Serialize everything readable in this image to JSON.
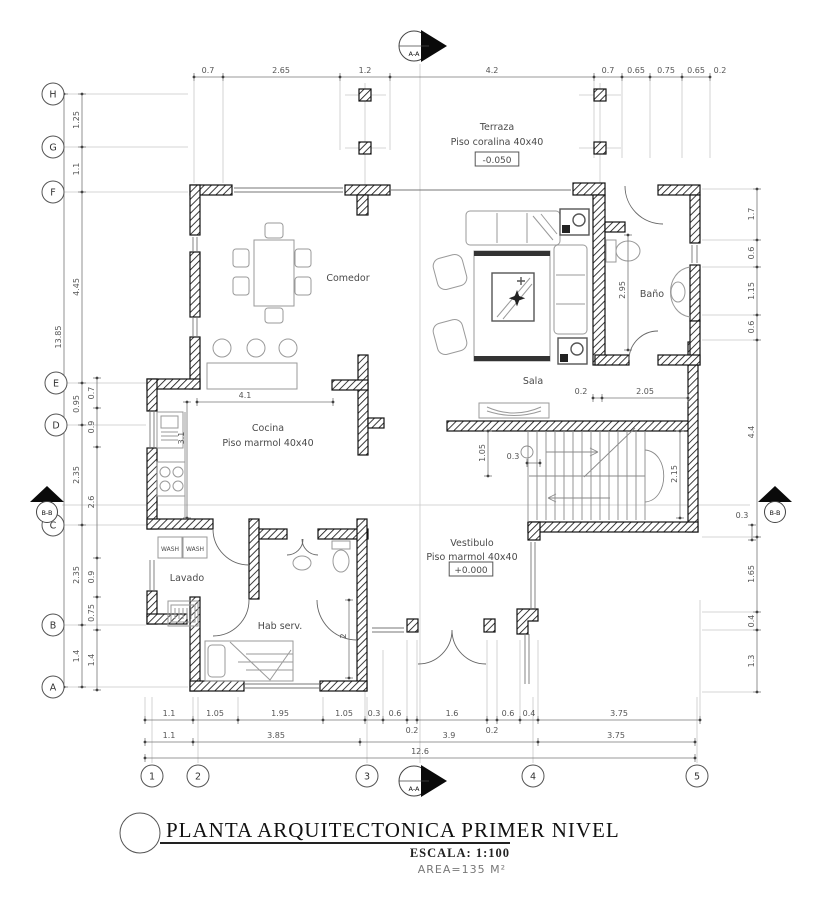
{
  "title_block": {
    "title": "PLANTA ARQUITECTONICA PRIMER NIVEL",
    "scale": "ESCALA: 1:100",
    "area": "AREA=135 M²"
  },
  "grid": {
    "bubbles": [
      {
        "t": "H",
        "x": 53,
        "y": 94
      },
      {
        "t": "G",
        "x": 53,
        "y": 147
      },
      {
        "t": "F",
        "x": 53,
        "y": 192
      },
      {
        "t": "E",
        "x": 56,
        "y": 383
      },
      {
        "t": "D",
        "x": 56,
        "y": 425
      },
      {
        "t": "C",
        "x": 53,
        "y": 525
      },
      {
        "t": "B",
        "x": 53,
        "y": 625
      },
      {
        "t": "A",
        "x": 53,
        "y": 687
      },
      {
        "t": "1",
        "x": 152,
        "y": 776
      },
      {
        "t": "2",
        "x": 198,
        "y": 776
      },
      {
        "t": "3",
        "x": 367,
        "y": 776
      },
      {
        "t": "4",
        "x": 533,
        "y": 776
      },
      {
        "t": "5",
        "x": 697,
        "y": 776
      }
    ]
  },
  "section_markers": [
    {
      "t": "A-A",
      "x": 414,
      "y": 46,
      "type": "right"
    },
    {
      "t": "A-A",
      "x": 414,
      "y": 781,
      "type": "right"
    },
    {
      "t": "B-B",
      "x": 47,
      "y": 509,
      "type": "up"
    },
    {
      "t": "B-B",
      "x": 775,
      "y": 509,
      "type": "up"
    }
  ],
  "rooms": {
    "labels": [
      {
        "t": [
          "Terraza",
          "Piso coralina 40x40"
        ],
        "x": 497,
        "y": 130,
        "lh": 15
      },
      {
        "t": [
          "Comedor"
        ],
        "x": 348,
        "y": 281
      },
      {
        "t": [
          "Sala"
        ],
        "x": 533,
        "y": 384
      },
      {
        "t": [
          "Baño"
        ],
        "x": 652,
        "y": 297
      },
      {
        "t": [
          "Cocina",
          "Piso marmol 40x40"
        ],
        "x": 268,
        "y": 431,
        "lh": 15
      },
      {
        "t": [
          "Vestibulo",
          "Piso marmol 40x40"
        ],
        "x": 472,
        "y": 546,
        "lh": 14
      },
      {
        "t": [
          "Lavado"
        ],
        "x": 187,
        "y": 581
      },
      {
        "t": [
          "Hab serv."
        ],
        "x": 280,
        "y": 629
      },
      {
        "t": [
          "WASH"
        ],
        "x": 170,
        "y": 551,
        "s": 6
      },
      {
        "t": [
          "WASH"
        ],
        "x": 195,
        "y": 551,
        "s": 6
      }
    ],
    "levels": [
      {
        "t": "-0.050",
        "x": 497,
        "y": 160
      },
      {
        "t": "+0.000",
        "x": 471,
        "y": 570
      }
    ]
  },
  "dimensions": [
    {
      "o": "h",
      "pos": 77,
      "from": 194,
      "to": 710,
      "ticks": [
        194,
        223,
        340,
        390,
        594,
        622,
        650,
        682,
        710
      ],
      "labels": [
        {
          "t": "0.7",
          "at": 208
        },
        {
          "t": "2.65",
          "at": 281
        },
        {
          "t": "1.2",
          "at": 365
        },
        {
          "t": "4.2",
          "at": 492
        },
        {
          "t": "0.7",
          "at": 608
        },
        {
          "t": "0.65",
          "at": 636
        },
        {
          "t": "0.75",
          "at": 666
        },
        {
          "t": "0.65",
          "at": 696
        },
        {
          "t": "0.2",
          "at": 720
        }
      ]
    },
    {
      "o": "v",
      "pos": 64,
      "from": 94,
      "to": 687,
      "ticks": [
        94,
        687
      ],
      "labels": [
        {
          "t": "13.85",
          "at": 337
        }
      ]
    },
    {
      "o": "v",
      "pos": 82,
      "from": 94,
      "to": 687,
      "ticks": [
        94,
        147,
        192,
        383,
        425,
        525,
        625,
        687
      ],
      "labels": [
        {
          "t": "1.25",
          "at": 120
        },
        {
          "t": "1.1",
          "at": 169
        },
        {
          "t": "4.45",
          "at": 287
        },
        {
          "t": "0.95",
          "at": 404
        },
        {
          "t": "2.35",
          "at": 475
        },
        {
          "t": "2.35",
          "at": 575
        },
        {
          "t": "1.4",
          "at": 656
        }
      ]
    },
    {
      "o": "v",
      "pos": 97,
      "from": 378,
      "to": 690,
      "ticks": [
        378,
        408,
        447,
        558,
        597,
        630,
        690
      ],
      "labels": [
        {
          "t": "0.7",
          "at": 393
        },
        {
          "t": "0.9",
          "at": 427
        },
        {
          "t": "2.6",
          "at": 502
        },
        {
          "t": "0.9",
          "at": 577
        },
        {
          "t": "0.75",
          "at": 613
        },
        {
          "t": "1.4",
          "at": 660
        }
      ]
    },
    {
      "o": "v",
      "pos": 757,
      "from": 189,
      "to": 692,
      "ticks": [
        189,
        240,
        267,
        315,
        340,
        537,
        612,
        630,
        692
      ],
      "labels": [
        {
          "t": "1.7",
          "at": 214
        },
        {
          "t": "0.6",
          "at": 253
        },
        {
          "t": "1.15",
          "at": 291
        },
        {
          "t": "0.6",
          "at": 327
        },
        {
          "t": "4.4",
          "at": 432
        },
        {
          "t": "1.65",
          "at": 574
        },
        {
          "t": "0.4",
          "at": 621
        },
        {
          "t": "1.3",
          "at": 661
        }
      ]
    },
    {
      "o": "v",
      "pos": 752,
      "from": 525,
      "to": 540,
      "ticks": [
        525,
        540
      ],
      "labels": [
        {
          "t": "0.3",
          "at": 518,
          "h": 1,
          "dx": -10
        }
      ]
    },
    {
      "o": "h",
      "pos": 720,
      "from": 145,
      "to": 700,
      "ticks": [
        145,
        193,
        238,
        323,
        365,
        383,
        407,
        417,
        487,
        497,
        520,
        538,
        700
      ],
      "labels": [
        {
          "t": "1.1",
          "at": 169
        },
        {
          "t": "1.05",
          "at": 215
        },
        {
          "t": "1.95",
          "at": 280
        },
        {
          "t": "1.05",
          "at": 344
        },
        {
          "t": "0.3",
          "at": 374
        },
        {
          "t": "0.6",
          "at": 395
        },
        {
          "t": "1.6",
          "at": 452
        },
        {
          "t": "0.6",
          "at": 508
        },
        {
          "t": "0.4",
          "at": 529
        },
        {
          "t": "3.75",
          "at": 619
        },
        {
          "t": "0.2",
          "at": 412,
          "dy": 13
        },
        {
          "t": "0.2",
          "at": 492,
          "dy": 13
        }
      ]
    },
    {
      "o": "h",
      "pos": 742,
      "from": 145,
      "to": 695,
      "ticks": [
        145,
        193,
        360,
        538,
        695
      ],
      "labels": [
        {
          "t": "1.1",
          "at": 169
        },
        {
          "t": "3.85",
          "at": 276
        },
        {
          "t": "3.9",
          "at": 449
        },
        {
          "t": "3.75",
          "at": 616
        }
      ]
    },
    {
      "o": "h",
      "pos": 758,
      "from": 145,
      "to": 695,
      "ticks": [
        145,
        695
      ],
      "labels": [
        {
          "t": "12.6",
          "at": 420
        }
      ]
    },
    {
      "o": "h",
      "pos": 402,
      "from": 197,
      "to": 333,
      "ticks": [
        197,
        333
      ],
      "labels": [
        {
          "t": "4.1",
          "at": 245
        }
      ]
    },
    {
      "o": "v",
      "pos": 187,
      "from": 402,
      "to": 518,
      "ticks": [
        402,
        518
      ],
      "labels": [
        {
          "t": "3.1",
          "at": 438
        }
      ]
    },
    {
      "o": "h",
      "pos": 398,
      "from": 593,
      "to": 688,
      "ticks": [
        593,
        602,
        688
      ],
      "labels": [
        {
          "t": "0.2",
          "at": 581
        },
        {
          "t": "2.05",
          "at": 645
        }
      ]
    },
    {
      "o": "v",
      "pos": 488,
      "from": 431,
      "to": 476,
      "ticks": [
        431,
        476
      ],
      "labels": [
        {
          "t": "1.05",
          "at": 453
        }
      ]
    },
    {
      "o": "h",
      "pos": 463,
      "from": 527,
      "to": 540,
      "ticks": [
        527,
        540
      ],
      "labels": [
        {
          "t": "0.3",
          "at": 513
        }
      ]
    },
    {
      "o": "v",
      "pos": 680,
      "from": 431,
      "to": 518,
      "ticks": [
        431,
        518
      ],
      "labels": [
        {
          "t": "2.15",
          "at": 474
        }
      ]
    },
    {
      "o": "v",
      "pos": 628,
      "from": 235,
      "to": 350,
      "ticks": [
        235,
        350
      ],
      "labels": [
        {
          "t": "2.95",
          "at": 290
        }
      ]
    },
    {
      "o": "v",
      "pos": 349,
      "from": 600,
      "to": 678,
      "ticks": [
        600,
        678
      ],
      "labels": [
        {
          "t": "2",
          "at": 636
        }
      ]
    }
  ]
}
